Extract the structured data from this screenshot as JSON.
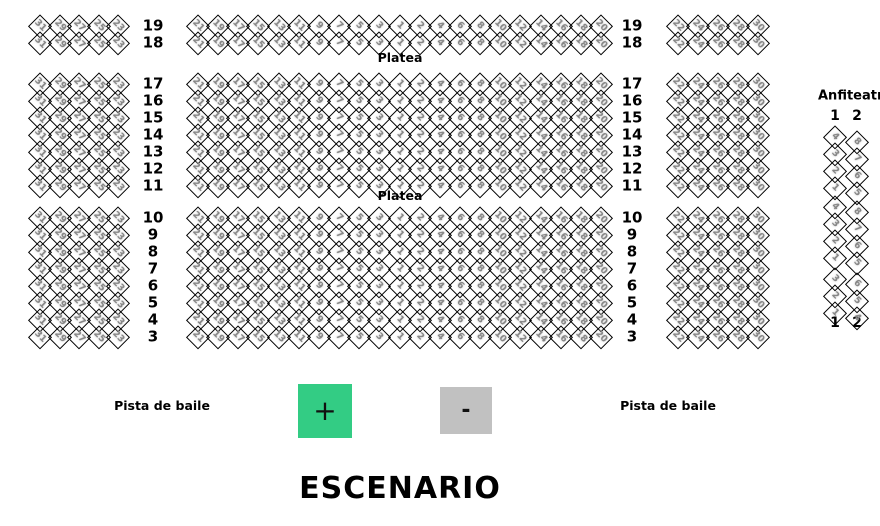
{
  "canvas": {
    "width": 880,
    "height": 526,
    "background": "#ffffff"
  },
  "colors": {
    "seat_border": "#000000",
    "seat_number": "#868686",
    "label_text": "#000000",
    "zoom_in_bg": "#33cc84",
    "zoom_out_bg": "#c1c1c1",
    "zoom_glyph": "#111111"
  },
  "platea": {
    "label": "Platea",
    "left_cols": [
      "31",
      "29",
      "27",
      "25",
      "23"
    ],
    "center_cols": [
      "21",
      "19",
      "17",
      "15",
      "13",
      "11",
      "9",
      "7",
      "5",
      "3",
      "1",
      "2",
      "4",
      "6",
      "8",
      "10",
      "12",
      "14",
      "16",
      "18",
      "20"
    ],
    "right_cols": [
      "22",
      "24",
      "26",
      "28",
      "30"
    ],
    "sections": [
      {
        "rows": [
          "19",
          "18"
        ],
        "y": 26
      },
      {
        "rows": [
          "17",
          "16",
          "15",
          "14",
          "13",
          "12",
          "11"
        ],
        "y": 84
      },
      {
        "rows": [
          "10",
          "9",
          "8",
          "7",
          "6",
          "5",
          "4",
          "3"
        ],
        "y": 218
      }
    ]
  },
  "anfiteatro": {
    "title": "Anfiteatro",
    "col_headers": [
      "1",
      "2"
    ],
    "col_footers": [
      "1",
      "2"
    ],
    "groups": [
      {
        "y": 137,
        "columns": [
          [
            "4",
            "3",
            "2",
            "1"
          ],
          [
            "8",
            "7",
            "6",
            "5"
          ]
        ]
      },
      {
        "y": 207,
        "columns": [
          [
            "4",
            "3",
            "2",
            "1"
          ],
          [
            "8",
            "7",
            "6",
            "5"
          ]
        ]
      },
      {
        "y": 279,
        "columns": [
          [
            "3",
            "2",
            "1"
          ],
          [
            "6",
            "5",
            "4"
          ]
        ]
      }
    ]
  },
  "dance_floor": {
    "left_label": "Pista de baile",
    "right_label": "Pista de baile"
  },
  "zoom_controls": {
    "zoom_in": {
      "label": "+"
    },
    "zoom_out": {
      "label": "-"
    }
  },
  "stage": {
    "label": "ESCENARIO"
  },
  "layout": {
    "row_dy": 17,
    "left_x": 40,
    "left_dx": 19.5,
    "center_x": 198,
    "center_dx": 20.15,
    "right_x": 678,
    "right_dx": 20,
    "row_label_x": [
      153,
      632
    ],
    "anf_col_x": [
      835,
      857
    ],
    "anf_header_y": 116,
    "anf_footer_y": 323,
    "anf_col2_dy": 5
  }
}
